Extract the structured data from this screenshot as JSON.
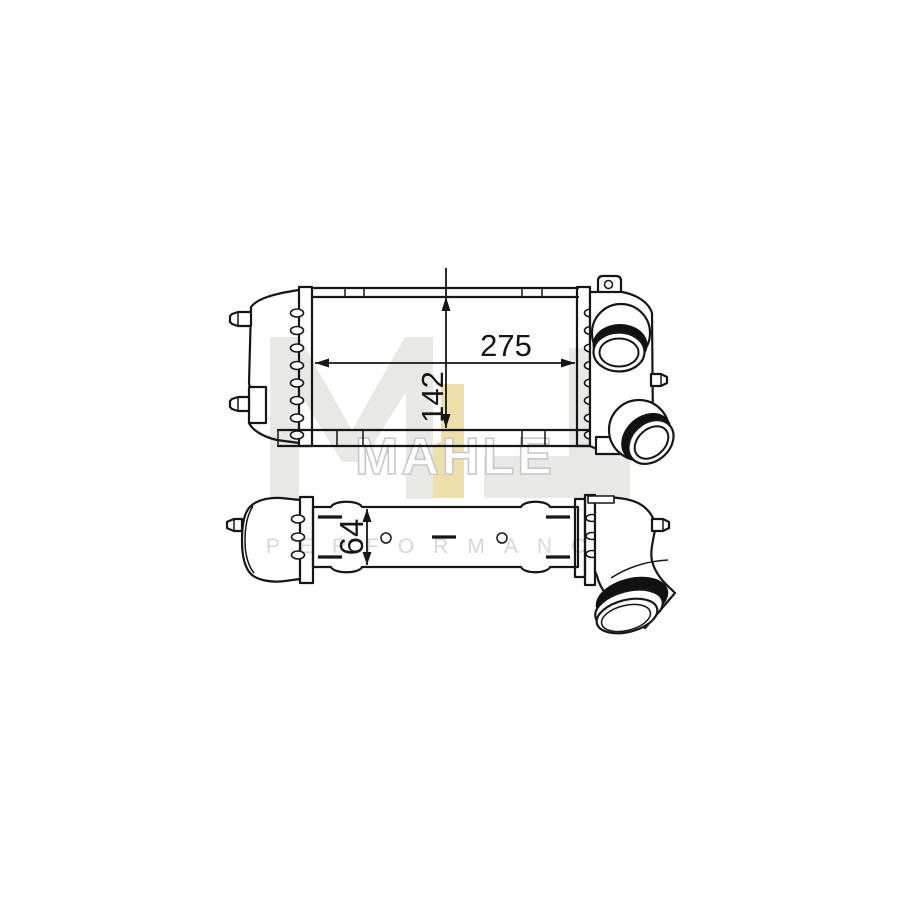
{
  "page": {
    "background": "#ffffff",
    "width": 900,
    "height": 900
  },
  "watermark": {
    "brand": "MAHLE",
    "tagline": "PERFORMANCE",
    "logo": {
      "letters": [
        "M",
        "L"
      ],
      "letter_color": "#e8e8e6",
      "accent_color": "#eddfa9"
    },
    "brand_outline_color": "#c8c8c8",
    "tagline_color": "#d7d7d5"
  },
  "drawing": {
    "subject": "intercooler technical drawing, two orthographic views",
    "line_color": "#161616",
    "dimensions": [
      {
        "id": "core-width",
        "value": "275",
        "orientation": "horizontal",
        "view": "top-view"
      },
      {
        "id": "core-height",
        "value": "142",
        "orientation": "vertical",
        "view": "top-view"
      },
      {
        "id": "core-depth",
        "value": "64",
        "orientation": "vertical",
        "view": "side-view"
      }
    ]
  }
}
